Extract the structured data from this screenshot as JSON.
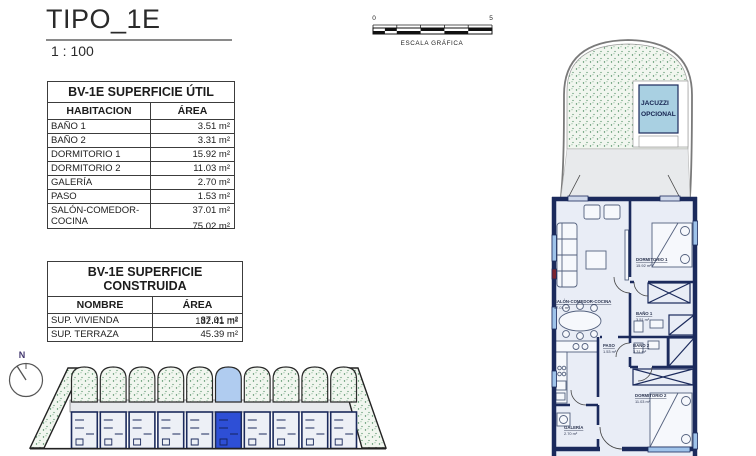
{
  "header": {
    "title": "TIPO_1E",
    "scale": "1 : 100"
  },
  "scale_bar": {
    "start": "0",
    "end": "5",
    "caption": "ESCALA GRÁFICA"
  },
  "tables": {
    "util": {
      "title": "BV-1E SUPERFICIE ÚTIL",
      "col_name": "HABITACION",
      "col_area": "ÁREA",
      "rows": [
        {
          "name": "BAÑO 1",
          "area": "3.51 m²"
        },
        {
          "name": "BAÑO 2",
          "area": "3.31 m²"
        },
        {
          "name": "DORMITORIO 1",
          "area": "15.92 m²"
        },
        {
          "name": "DORMITORIO 2",
          "area": "11.03 m²"
        },
        {
          "name": "GALERÍA",
          "area": "2.70 m²"
        },
        {
          "name": "PASO",
          "area": "1.53 m²"
        },
        {
          "name": "SALÓN-COMEDOR-COCINA",
          "area": "37.01 m²"
        }
      ],
      "total": "75.02 m²"
    },
    "construida": {
      "title": "BV-1E SUPERFICIE CONSTRUIDA",
      "col_name": "NOMBRE",
      "col_area": "ÁREA",
      "rows": [
        {
          "name": "SUP. VIVIENDA",
          "area": "87.01 m²"
        },
        {
          "name": "SUP. TERRAZA",
          "area": "45.39 m²"
        }
      ],
      "total": "132.41 m²"
    }
  },
  "site_plan": {
    "compass_label": "N",
    "units_total": 10,
    "highlighted_unit_index": 5
  },
  "floor_plan": {
    "jacuzzi_line1": "JACUZZI",
    "jacuzzi_line2": "OPCIONAL",
    "rooms": {
      "salon": {
        "name": "SALÓN-COMEDOR-COCINA",
        "area": "37.01 m²"
      },
      "dorm1": {
        "name": "DORMITORIO 1",
        "area": "15.92 m²"
      },
      "bano1": {
        "name": "BAÑO 1",
        "area": "3.51 m²"
      },
      "paso": {
        "name": "PASO",
        "area": "1.53 m²"
      },
      "bano2": {
        "name": "BAÑO 2",
        "area": "3.31 m²"
      },
      "dorm2": {
        "name": "DORMITORIO 2",
        "area": "11.03 m²"
      },
      "galeria": {
        "name": "GALERÍA",
        "area": "2.70 m²"
      }
    }
  },
  "colors": {
    "wall_navy": "#1b2a5c",
    "floor": "#e9edf6",
    "terrace_grey": "#e8eaec",
    "speckle_bg": "#f1f6ef",
    "speckle_dot": "#4a8a5e",
    "highlight_terrace": "#b0ccf0",
    "highlight_body": "#2e4fd6",
    "jacuzzi_blue": "#a9d0e2",
    "window_blue": "#9fc3ea"
  }
}
